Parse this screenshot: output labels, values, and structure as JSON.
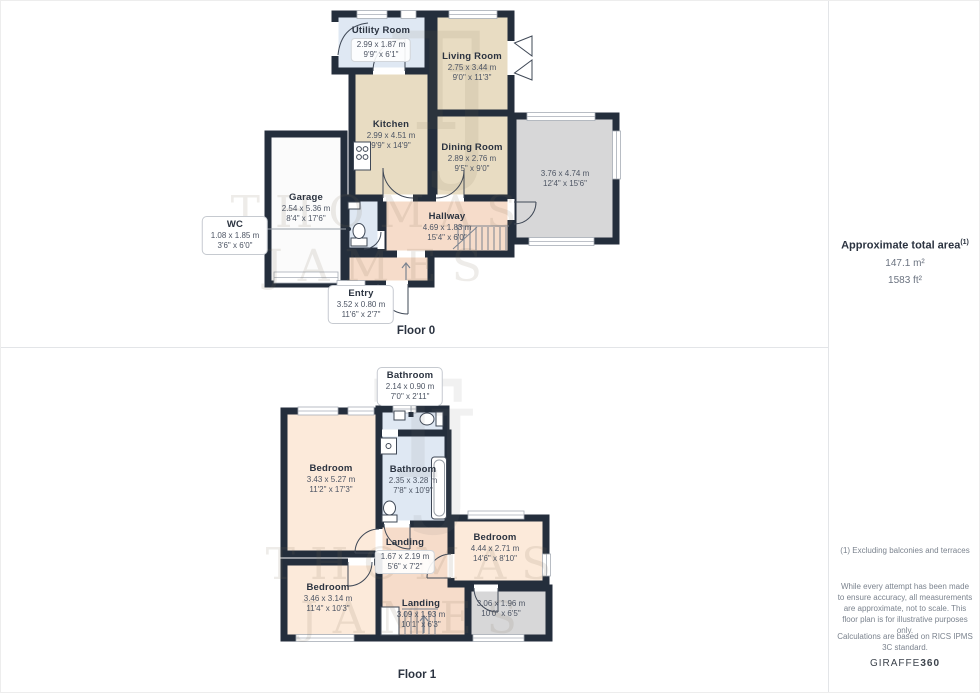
{
  "floor0": {
    "label": "Floor 0",
    "rooms": {
      "utility": {
        "name": "Utility Room",
        "metric": "2.99 x 1.87 m",
        "imperial": "9'9\" x 6'1\""
      },
      "living": {
        "name": "Living Room",
        "metric": "2.75 x 3.44 m",
        "imperial": "9'0\" x 11'3\""
      },
      "kitchen": {
        "name": "Kitchen",
        "metric": "2.99 x 4.51 m",
        "imperial": "9'9\" x 14'9\""
      },
      "dining": {
        "name": "Dining Room",
        "metric": "2.89 x 2.76 m",
        "imperial": "9'5\" x 9'0\""
      },
      "conservatory": {
        "name": "",
        "metric": "3.76 x 4.74 m",
        "imperial": "12'4\" x 15'6\""
      },
      "garage": {
        "name": "Garage",
        "metric": "2.54 x 5.36 m",
        "imperial": "8'4\" x 17'6\""
      },
      "wc": {
        "name": "WC",
        "metric": "1.08 x 1.85 m",
        "imperial": "3'6\" x 6'0\""
      },
      "hallway": {
        "name": "Hallway",
        "metric": "4.69 x 1.83 m",
        "imperial": "15'4\" x 6'0\""
      },
      "entry": {
        "name": "Entry",
        "metric": "3.52 x 0.80 m",
        "imperial": "11'6\" x 2'7\""
      }
    }
  },
  "floor1": {
    "label": "Floor 1",
    "rooms": {
      "bathroom_top": {
        "name": "Bathroom",
        "metric": "2.14 x 0.90 m",
        "imperial": "7'0\" x 2'11\""
      },
      "bedroom_left": {
        "name": "Bedroom",
        "metric": "3.43 x 5.27 m",
        "imperial": "11'2\" x 17'3\""
      },
      "bathroom_main": {
        "name": "Bathroom",
        "metric": "2.35 x 3.28 m",
        "imperial": "7'8\" x 10'9\""
      },
      "bedroom_right": {
        "name": "Bedroom",
        "metric": "4.44 x 2.71 m",
        "imperial": "14'6\" x 8'10\""
      },
      "landing_upper": {
        "name": "Landing",
        "metric": "1.67 x 2.19 m",
        "imperial": "5'6\" x 7'2\""
      },
      "bedroom_back": {
        "name": "Bedroom",
        "metric": "3.46 x 3.14 m",
        "imperial": "11'4\" x 10'3\""
      },
      "landing_lower": {
        "name": "Landing",
        "metric": "3.09 x 1.93 m",
        "imperial": "10'1\" x 6'3\""
      },
      "store": {
        "name": "",
        "metric": "3.06 x 1.96 m",
        "imperial": "10'0\" x 6'5\""
      }
    }
  },
  "sidebar": {
    "area_title": "Approximate total area",
    "area_sup": "(1)",
    "area_m2": "147.1 m²",
    "area_ft2": "1583 ft²",
    "footnote": "(1) Excluding balconies and terraces",
    "disclaimer": "While every attempt has been made to ensure accuracy, all measurements are approximate, not to scale. This floor plan is for illustrative purposes only.",
    "calculations": "Calculations are based on RICS IPMS 3C standard.",
    "brand_giraffe": "GIRAFFE",
    "brand_360": "360"
  },
  "watermark": {
    "line1": "THOMAS",
    "line2": "JAMES",
    "mono_t": "T",
    "mono_j": "J"
  },
  "colors": {
    "wall": "#242e3c",
    "room_beige": "#e8dcc2",
    "room_blue": "#dfe8f3",
    "room_salmon": "#f6dcca",
    "room_cream": "#fceada",
    "room_gray": "#d7d7d8",
    "garage_white": "#fbfbfb",
    "text_dark": "#2b3340",
    "text_dim": "#4d5564"
  }
}
